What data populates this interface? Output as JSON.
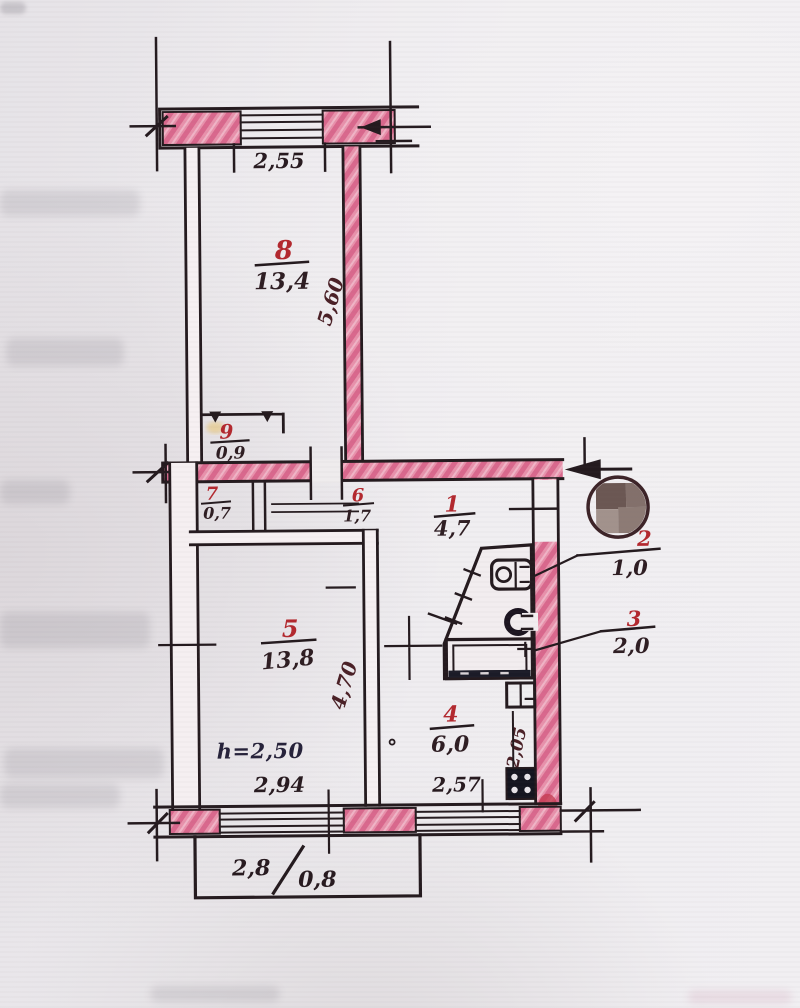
{
  "rooms": {
    "r1": {
      "num": "1",
      "area": "4,7"
    },
    "r2": {
      "num": "2",
      "area": "1,0"
    },
    "r3": {
      "num": "3",
      "area": "2,0"
    },
    "r4": {
      "num": "4",
      "area": "6,0"
    },
    "r5": {
      "num": "5",
      "area": "13,8"
    },
    "r6": {
      "num": "6",
      "area": "1,7"
    },
    "r7": {
      "num": "7",
      "area": "0,7"
    },
    "r8": {
      "num": "8",
      "area": "13,4"
    },
    "r9": {
      "num": "9",
      "area": "0,9"
    }
  },
  "dimensions": {
    "top_window_width": "2,55",
    "room8_depth": "5,60",
    "room5_depth": "4,70",
    "room5_width": "2,94",
    "kitchen_width": "2,57",
    "kitchen_recess_depth": "2,05",
    "ceiling_height": "h=2,50",
    "balcony_length": "2,8",
    "balcony_width": "0,8"
  },
  "colors": {
    "wall_fill": "#e891ab",
    "wall_hatch": "#d9688d",
    "ink": "#241a1e",
    "room_number_red": "#b3282e",
    "paper": "#edeaee",
    "stamp_outline": "#3c2327"
  }
}
